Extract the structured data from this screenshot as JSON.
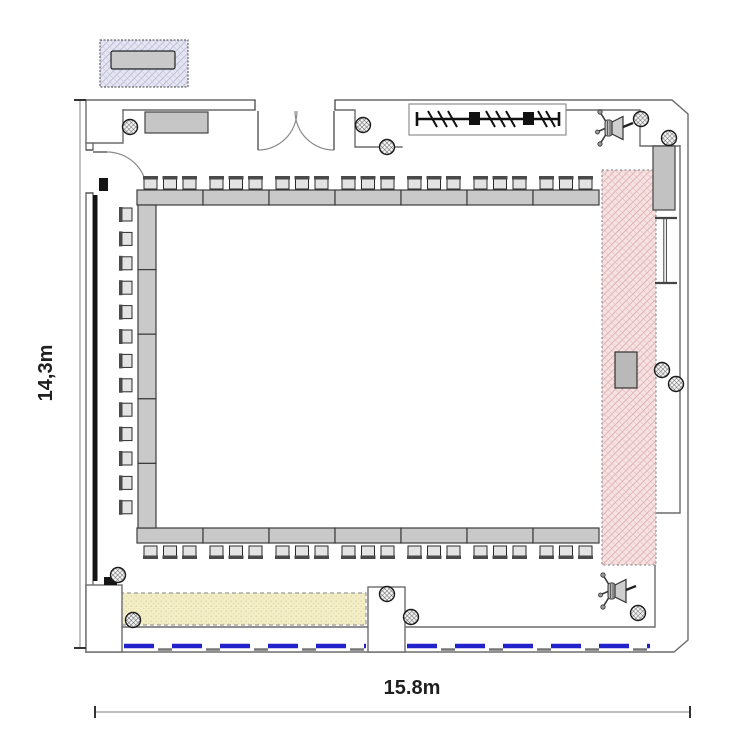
{
  "plan": {
    "height_label": "14,3m",
    "width_label": "15.8m",
    "arrangement": "hollow-square-open-right",
    "seats_top": 21,
    "seats_bottom": 21,
    "seats_left": 13,
    "seats_total": 55
  },
  "legend": {
    "item": "table-with-two-chairs-sample"
  },
  "colors": {
    "table": "#c9c9c9",
    "chair_seat": "#e3e3e3",
    "chair_back": "#4a4a4a",
    "projection_zone_hatch": "#dca8a8",
    "buffet_zone": "#f3eec6",
    "window_marker_blue": "#2323cc",
    "legend_zone_hatch": "#b4b4d6",
    "wall": "#6b6b6b"
  },
  "furniture": {
    "table_runs": [
      {
        "name": "table-row-top",
        "x": 137,
        "y": 190,
        "len": 462,
        "depth": 15,
        "dir": "h",
        "segments": 7
      },
      {
        "name": "table-row-bottom",
        "x": 137,
        "y": 528,
        "len": 462,
        "depth": 15,
        "dir": "h",
        "segments": 7
      },
      {
        "name": "table-col-left",
        "x": 138,
        "y": 205,
        "len": 323,
        "depth": 18,
        "dir": "v",
        "segments": 5
      }
    ],
    "chair_rows": [
      {
        "name": "chairs-top",
        "orient": "up",
        "y": 176,
        "x0": 137,
        "seg_w": 66,
        "segments": 7,
        "per_segment": 3
      },
      {
        "name": "chairs-bottom",
        "orient": "down",
        "y": 546,
        "x0": 137,
        "seg_w": 66,
        "segments": 7,
        "per_segment": 3
      },
      {
        "name": "chairs-left",
        "orient": "left",
        "x": 119,
        "y0": 207,
        "count": 13,
        "step": 24.4
      },
      {
        "name": "legend-chairs",
        "orient": "down",
        "y": 70,
        "x0": 113,
        "seg_w": 28,
        "segments": 2,
        "per_segment": 1
      }
    ]
  },
  "columns": [
    [
      130,
      127
    ],
    [
      363,
      125
    ],
    [
      387,
      147
    ],
    [
      641,
      119
    ],
    [
      669,
      138
    ],
    [
      662,
      370
    ],
    [
      676,
      384
    ],
    [
      638,
      613
    ],
    [
      387,
      594
    ],
    [
      411,
      617
    ],
    [
      118,
      575
    ],
    [
      133,
      620
    ]
  ]
}
